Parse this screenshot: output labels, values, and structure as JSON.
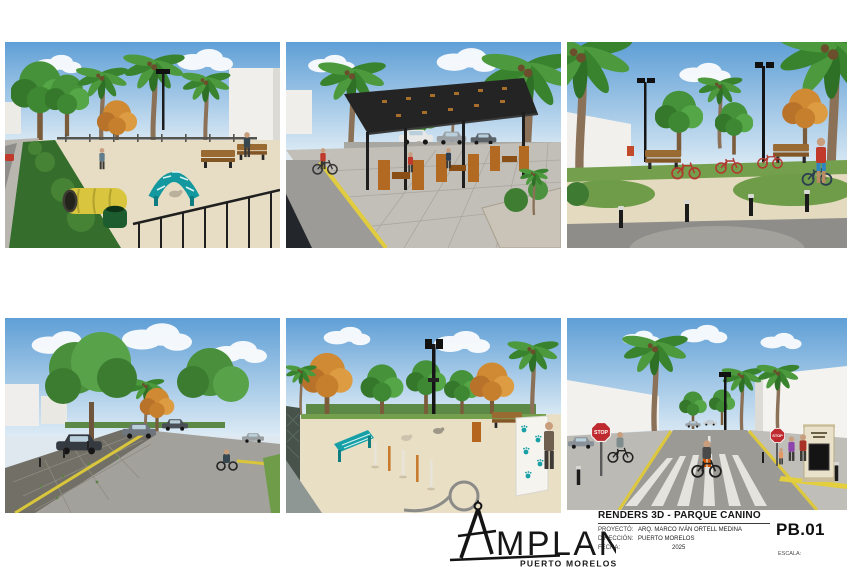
{
  "renders": [
    {
      "name": "dog-park-play-area-view"
    },
    {
      "name": "shade-pergola-seating-view"
    },
    {
      "name": "bike-racks-park-view"
    },
    {
      "name": "street-permeable-parking-view"
    },
    {
      "name": "dog-agility-course-view"
    },
    {
      "name": "crosswalk-entrance-view"
    }
  ],
  "title_block": {
    "title": "RENDERS 3D - PARQUE CANINO",
    "fields": [
      {
        "label": "PROYECTÓ:",
        "value": "ARQ. MARCO IVÁN ORTELL MEDINA"
      },
      {
        "label": "DIRECCIÓN:",
        "value": "PUERTO MORELOS"
      },
      {
        "label": "FECHA:",
        "value": "2025"
      }
    ],
    "sheet_number": "PB.01",
    "scale_label": "ESCALA:"
  },
  "logo": {
    "word": "MPLAN",
    "sub": "PUERTO MORELOS"
  },
  "scene_text": {
    "stop": "STOP"
  },
  "colors": {
    "accent_teal": "#12989e",
    "stop_red": "#bf2a2e",
    "curb_yellow": "#ddc83c",
    "sand": "#e7dcc4"
  }
}
